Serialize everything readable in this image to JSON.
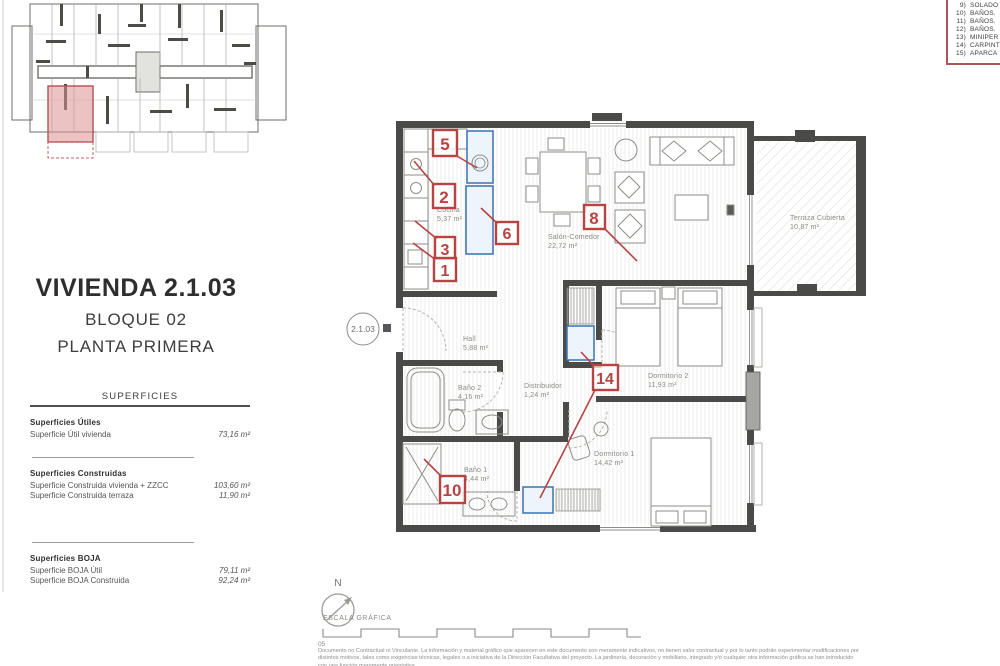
{
  "header": {
    "unit_title": "VIVIENDA 2.1.03",
    "block": "BLOQUE 02",
    "floor": "PLANTA PRIMERA"
  },
  "surfaces": {
    "title": "SUPERFICIES",
    "groups": [
      {
        "heading": "Superficies Útiles",
        "rows": [
          {
            "label": "Superficie Útil vivienda",
            "value": "73,16 m²"
          }
        ]
      },
      {
        "heading": "Superficies Construidas",
        "rows": [
          {
            "label": "Superficie Construida vivienda + ZZCC",
            "value": "103,60 m²"
          },
          {
            "label": "Superficie Construida terraza",
            "value": "11,90 m²"
          }
        ]
      },
      {
        "heading": "Superficies BOJA",
        "rows": [
          {
            "label": "Superficie BOJA Útil",
            "value": "79,11 m²"
          },
          {
            "label": "Superficie BOJA Construida",
            "value": "92,24 m²"
          }
        ]
      }
    ]
  },
  "legend": {
    "items": [
      {
        "num": "9)",
        "label": "SOLADO"
      },
      {
        "num": "10)",
        "label": "BAÑOS."
      },
      {
        "num": "11)",
        "label": "BAÑOS."
      },
      {
        "num": "12)",
        "label": "BAÑOS."
      },
      {
        "num": "13)",
        "label": "MINIPER"
      },
      {
        "num": "14)",
        "label": "CARPINT"
      },
      {
        "num": "15)",
        "label": "APARCA"
      }
    ]
  },
  "plan": {
    "unit_ref": "2.1.03",
    "rooms": [
      {
        "name": "Cocina",
        "area": "5,37 m²"
      },
      {
        "name": "Salón-Comedor",
        "area": "22,72 m²"
      },
      {
        "name": "Hall",
        "area": "5,88 m²"
      },
      {
        "name": "Baño 2",
        "area": "4,16 m²"
      },
      {
        "name": "Distribuidor",
        "area": "1,24 m²"
      },
      {
        "name": "Dormitorio 2",
        "area": "11,93 m²"
      },
      {
        "name": "Baño 1",
        "area": "4,44 m²"
      },
      {
        "name": "Dormitorio 1",
        "area": "14,42 m²"
      },
      {
        "name": "Terraza Cubierta",
        "area": "10,87 m²"
      }
    ],
    "markers": [
      "1",
      "2",
      "3",
      "5",
      "6",
      "8",
      "10",
      "14"
    ]
  },
  "footer": {
    "north_label": "N",
    "scale_label": "ESCALA GRÁFICA",
    "scale_origin": "05",
    "disclaimer1": "Documento no Contractual ni Vinculante. La información y material gráfico que aparecen en este documento son meramente indicativos, no tienen valor contractual y por lo tanto podrán experimentar modificaciones por",
    "disclaimer2": "distintos motivos, tales como exigencias técnicas, legales o a iniciativa de la Dirección Facultativa del proyecto. La jardinería, decoración y mobiliario, integrado y/o cualquier otra información gráfica se han introducido",
    "disclaimer3": "con una función meramente orientativa."
  },
  "colors": {
    "marker_red": "#b84343",
    "highlight_blue": "#4679b8",
    "keyplan_unit": "#d98a8a",
    "legend_border": "#b05555",
    "wall": "#4a4a48"
  }
}
